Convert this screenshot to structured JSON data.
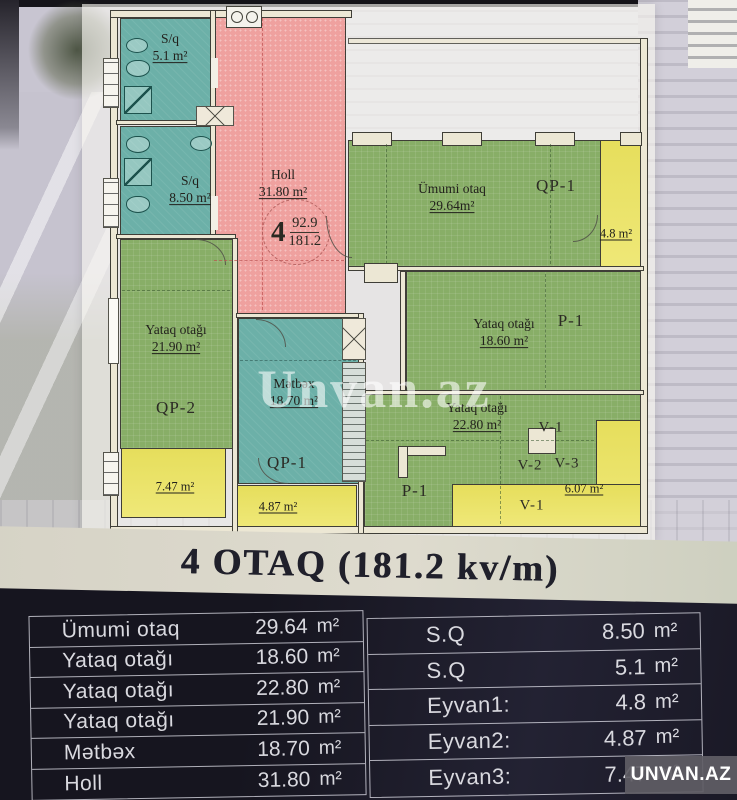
{
  "title": {
    "text": "4 OTAQ (181.2 kv/m)"
  },
  "watermark": {
    "plan_text": "Unvan.az",
    "badge_text": "UNVAN.AZ"
  },
  "plan": {
    "circle": {
      "number": "4",
      "upper": "92.9",
      "lower": "181.2"
    },
    "rooms": [
      {
        "label": "S/q",
        "area": "5.1 m²"
      },
      {
        "label": "S/q",
        "area": "8.50 m²"
      },
      {
        "label": "Holl",
        "area": "31.80 m²"
      },
      {
        "label": "Ümumi otaq",
        "area": "29.64m²"
      },
      {
        "label": "Yataq otağı",
        "area": "18.60 m²"
      },
      {
        "label": "Yataq otağı",
        "area": "22.80 m²"
      },
      {
        "label": "Yataq otağı",
        "area": "21.90 m²"
      },
      {
        "label": "Mətbəx",
        "area": "18.70 m²"
      }
    ],
    "balconies": [
      {
        "area": "4.8 m²"
      },
      {
        "area": "6.07 m²"
      },
      {
        "area": "7.47 m²"
      },
      {
        "area": "4.87 m²"
      }
    ],
    "zones": {
      "qp1_umumi": "QP-1",
      "p1_yataq1": "P-1",
      "v1_upper": "V-1",
      "v2": "V-2",
      "v3": "V-3",
      "v1_lower": "V-1",
      "p1_yataq2": "P-1",
      "qp2_yataq3": "QP-2",
      "qp1_metbex": "QP-1"
    }
  },
  "tables": {
    "left": {
      "rows": [
        {
          "name": "Ümumi otaq",
          "value": "29.64",
          "unit": "m²"
        },
        {
          "name": "Yataq otağı",
          "value": "18.60",
          "unit": "m²"
        },
        {
          "name": "Yataq otağı",
          "value": "22.80",
          "unit": "m²"
        },
        {
          "name": "Yataq otağı",
          "value": "21.90",
          "unit": "m²"
        },
        {
          "name": "Mətbəx",
          "value": "18.70",
          "unit": "m²"
        },
        {
          "name": "Holl",
          "value": "31.80",
          "unit": "m²"
        }
      ]
    },
    "right": {
      "rows": [
        {
          "name": "S.Q",
          "value": "8.50",
          "unit": "m²"
        },
        {
          "name": "S.Q",
          "value": "5.1",
          "unit": "m²"
        },
        {
          "name": "Eyvan1:",
          "value": "4.8",
          "unit": "m²"
        },
        {
          "name": "Eyvan2:",
          "value": "4.87",
          "unit": "m²"
        },
        {
          "name": "Eyvan3:",
          "value": "7.47",
          "unit": "m²"
        }
      ]
    }
  }
}
